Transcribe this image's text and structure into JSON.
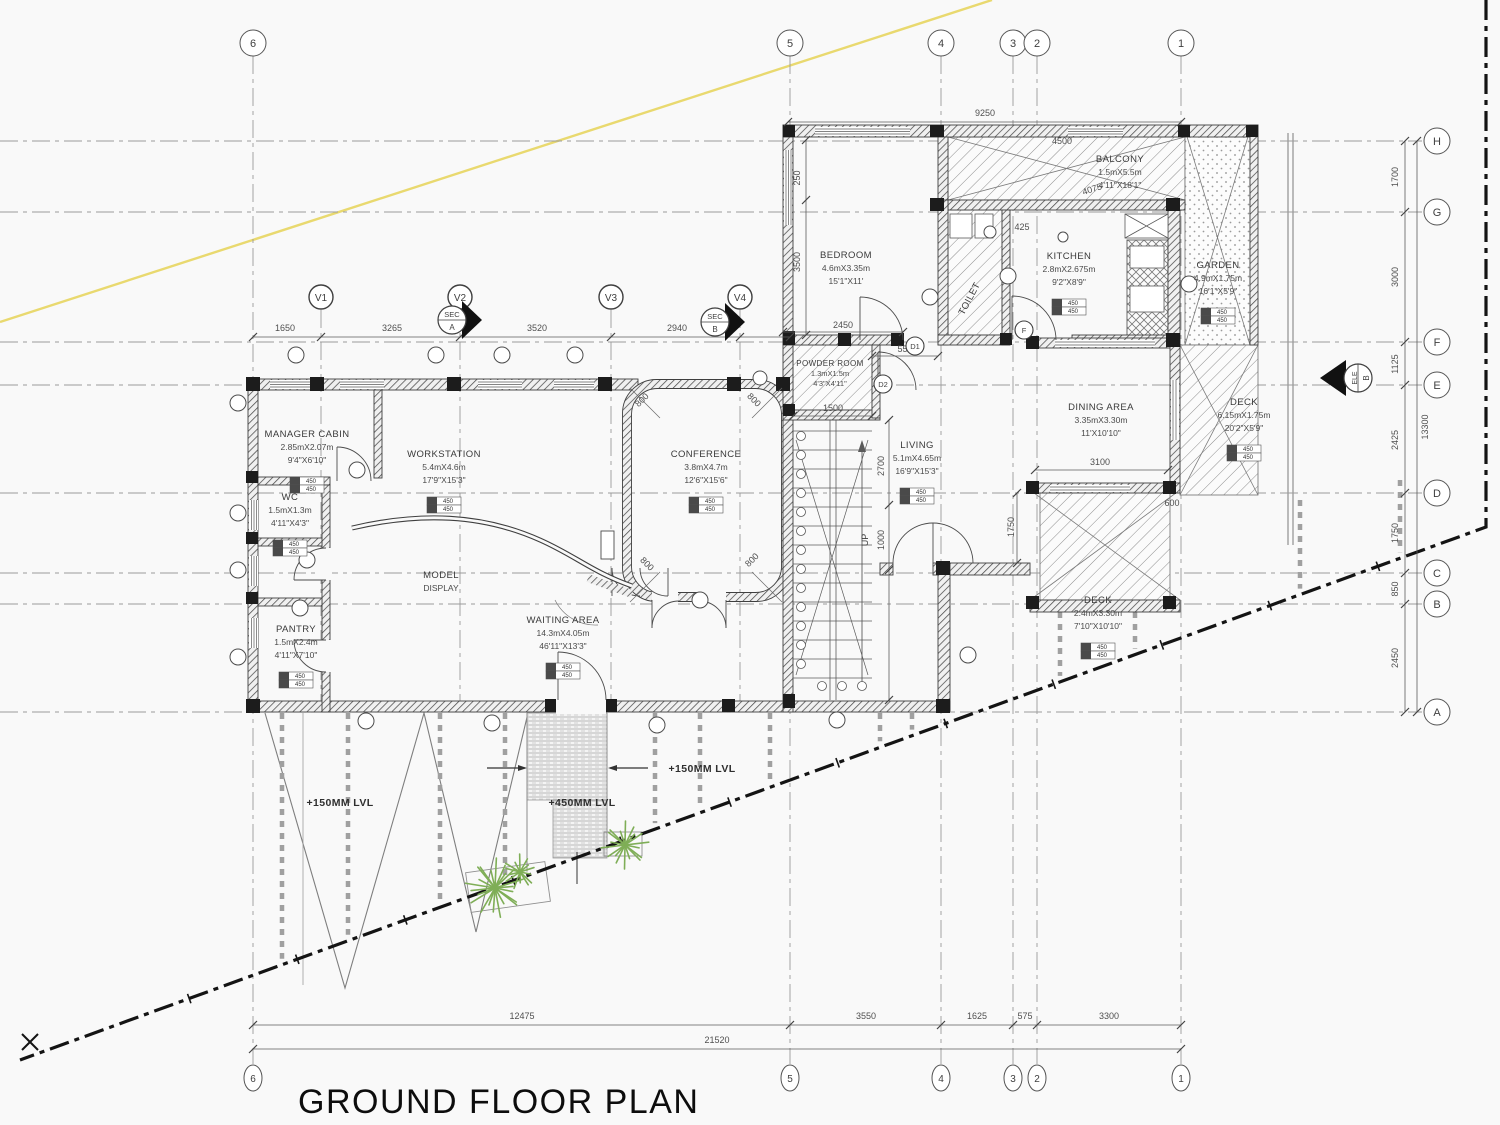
{
  "title": "GROUND FLOOR PLAN",
  "colors": {
    "accent_yellow": "#e9d96f",
    "plant_green": "#7fae57",
    "boundary_black": "#141414",
    "line_gray": "#555555"
  },
  "grid": {
    "columns": [
      {
        "label": "6",
        "x": 253
      },
      {
        "label": "5",
        "x": 790
      },
      {
        "label": "4",
        "x": 941
      },
      {
        "label": "3",
        "x": 1013
      },
      {
        "label": "2",
        "x": 1037
      },
      {
        "label": "1",
        "x": 1181
      }
    ],
    "rows": [
      {
        "label": "H",
        "y": 141
      },
      {
        "label": "G",
        "y": 212
      },
      {
        "label": "F",
        "y": 342
      },
      {
        "label": "E",
        "y": 385
      },
      {
        "label": "D",
        "y": 493
      },
      {
        "label": "C",
        "y": 573
      },
      {
        "label": "B",
        "y": 604
      },
      {
        "label": "A",
        "y": 712
      }
    ],
    "v_axes": [
      {
        "label": "V1",
        "x": 321
      },
      {
        "label": "V2",
        "x": 460
      },
      {
        "label": "V3",
        "x": 611
      },
      {
        "label": "V4",
        "x": 740
      }
    ]
  },
  "rooms": [
    {
      "lines": [
        "MANAGER CABIN",
        "2.85mX2.07m",
        "9'4\"X6'10\""
      ],
      "x": 307,
      "y": 437,
      "tag": true
    },
    {
      "lines": [
        "WC",
        "1.5mX1.3m",
        "4'11\"X4'3\""
      ],
      "x": 290,
      "y": 500,
      "tag": true
    },
    {
      "lines": [
        "PANTRY",
        "1.5mX2.4m",
        "4'11\"X7'10\""
      ],
      "x": 296,
      "y": 632,
      "tag": true
    },
    {
      "lines": [
        "WORKSTATION",
        "5.4mX4.6m",
        "17'9\"X15'3\""
      ],
      "x": 444,
      "y": 457,
      "tag": true
    },
    {
      "lines": [
        "MODEL",
        "DISPLAY"
      ],
      "x": 441,
      "y": 578
    },
    {
      "lines": [
        "WAITING AREA",
        "14.3mX4.05m",
        "46'11\"X13'3\""
      ],
      "x": 563,
      "y": 623,
      "tag": true
    },
    {
      "lines": [
        "CONFERENCE",
        "3.8mX4.7m",
        "12'6\"X15'6\""
      ],
      "x": 706,
      "y": 457,
      "tag": true
    },
    {
      "lines": [
        "BEDROOM",
        "4.6mX3.35m",
        "15'1\"X11'"
      ],
      "x": 846,
      "y": 258
    },
    {
      "lines": [
        "KITCHEN",
        "2.8mX2.675m",
        "9'2\"X8'9\""
      ],
      "x": 1069,
      "y": 259,
      "tag": true
    },
    {
      "lines": [
        "GARDEN",
        "4.9mX1.75m",
        "16'1\"X5'9\""
      ],
      "x": 1218,
      "y": 268,
      "tag": true
    },
    {
      "lines": [
        "BALCONY",
        "1.5mX5.5m",
        "4'11\"X18'1\""
      ],
      "x": 1120,
      "y": 162
    },
    {
      "lines": [
        "POWDER ROOM",
        "1.3mX1.5m",
        "4'3\"X4'11\""
      ],
      "x": 830,
      "y": 366,
      "small": true
    },
    {
      "lines": [
        "TOILET"
      ],
      "x": 972,
      "y": 300,
      "rot": -62
    },
    {
      "lines": [
        "LIVING",
        "5.1mX4.65m",
        "16'9\"X15'3\""
      ],
      "x": 917,
      "y": 448,
      "tag": true
    },
    {
      "lines": [
        "DINING AREA",
        "3.35mX3.30m",
        "11'X10'10\""
      ],
      "x": 1101,
      "y": 410
    },
    {
      "lines": [
        "DECK",
        "6.15mX1.75m",
        "20'2\"X5'9\""
      ],
      "x": 1244,
      "y": 405,
      "tag": true
    },
    {
      "lines": [
        "DECK",
        "2.4mX3.30m",
        "7'10\"X10'10\""
      ],
      "x": 1098,
      "y": 603,
      "tag": true
    }
  ],
  "level_tag_rows": [
    "450",
    "450"
  ],
  "dims": [
    {
      "t": "1650",
      "x": 285,
      "y": 331
    },
    {
      "t": "3265",
      "x": 392,
      "y": 331
    },
    {
      "t": "3520",
      "x": 537,
      "y": 331
    },
    {
      "t": "2940",
      "x": 677,
      "y": 331
    },
    {
      "t": "9250",
      "x": 985,
      "y": 116
    },
    {
      "t": "1700",
      "x": 1398,
      "y": 177,
      "r": -90
    },
    {
      "t": "3000",
      "x": 1398,
      "y": 277,
      "r": -90
    },
    {
      "t": "1125",
      "x": 1398,
      "y": 364,
      "r": -90
    },
    {
      "t": "2425",
      "x": 1398,
      "y": 440,
      "r": -90
    },
    {
      "t": "1750",
      "x": 1398,
      "y": 533,
      "r": -90
    },
    {
      "t": "850",
      "x": 1398,
      "y": 589,
      "r": -90
    },
    {
      "t": "2450",
      "x": 1398,
      "y": 658,
      "r": -90
    },
    {
      "t": "13300",
      "x": 1428,
      "y": 427,
      "r": -90
    },
    {
      "t": "12475",
      "x": 522,
      "y": 1019
    },
    {
      "t": "3550",
      "x": 866,
      "y": 1019
    },
    {
      "t": "1625",
      "x": 977,
      "y": 1019
    },
    {
      "t": "575",
      "x": 1025,
      "y": 1019
    },
    {
      "t": "3300",
      "x": 1109,
      "y": 1019
    },
    {
      "t": "21520",
      "x": 717,
      "y": 1043
    },
    {
      "t": "2450",
      "x": 843,
      "y": 328
    },
    {
      "t": "550",
      "x": 905,
      "y": 352
    },
    {
      "t": "425",
      "x": 1022,
      "y": 230
    },
    {
      "t": "4075",
      "x": 1093,
      "y": 192,
      "r": -18
    },
    {
      "t": "4500",
      "x": 1062,
      "y": 144
    },
    {
      "t": "1500",
      "x": 833,
      "y": 411
    },
    {
      "t": "2700",
      "x": 884,
      "y": 466,
      "r": -90
    },
    {
      "t": "1000",
      "x": 884,
      "y": 540,
      "r": -90
    },
    {
      "t": "3100",
      "x": 1100,
      "y": 465
    },
    {
      "t": "600",
      "x": 1172,
      "y": 506
    },
    {
      "t": "1750",
      "x": 1014,
      "y": 527,
      "r": -90
    },
    {
      "t": "3500",
      "x": 800,
      "y": 262,
      "r": -90
    },
    {
      "t": "250",
      "x": 800,
      "y": 178,
      "r": -90
    },
    {
      "t": "800",
      "x": 644,
      "y": 402,
      "r": -45
    },
    {
      "t": "800",
      "x": 752,
      "y": 402,
      "r": 45
    },
    {
      "t": "800",
      "x": 645,
      "y": 566,
      "r": 45
    },
    {
      "t": "800",
      "x": 754,
      "y": 562,
      "r": -45
    }
  ],
  "levels": [
    {
      "text": "+150MM LVL",
      "x": 340,
      "y": 806
    },
    {
      "text": "+450MM LVL",
      "x": 582,
      "y": 806
    },
    {
      "text": "+150MM LVL",
      "x": 702,
      "y": 772
    }
  ],
  "markers": {
    "sections": [
      {
        "line1": "SEC",
        "line2": "A",
        "x": 452,
        "y": 320
      },
      {
        "line1": "SEC",
        "line2": "B",
        "x": 715,
        "y": 322
      }
    ],
    "elevation": {
      "line1": "ELE",
      "line2": "B",
      "x": 1358,
      "y": 378
    },
    "door_tags": [
      {
        "text": "D1",
        "x": 915,
        "y": 346
      },
      {
        "text": "D2",
        "x": 883,
        "y": 384
      },
      {
        "text": "F",
        "x": 1024,
        "y": 330
      }
    ],
    "up_label": {
      "text": "UP",
      "x": 868,
      "y": 540
    }
  }
}
